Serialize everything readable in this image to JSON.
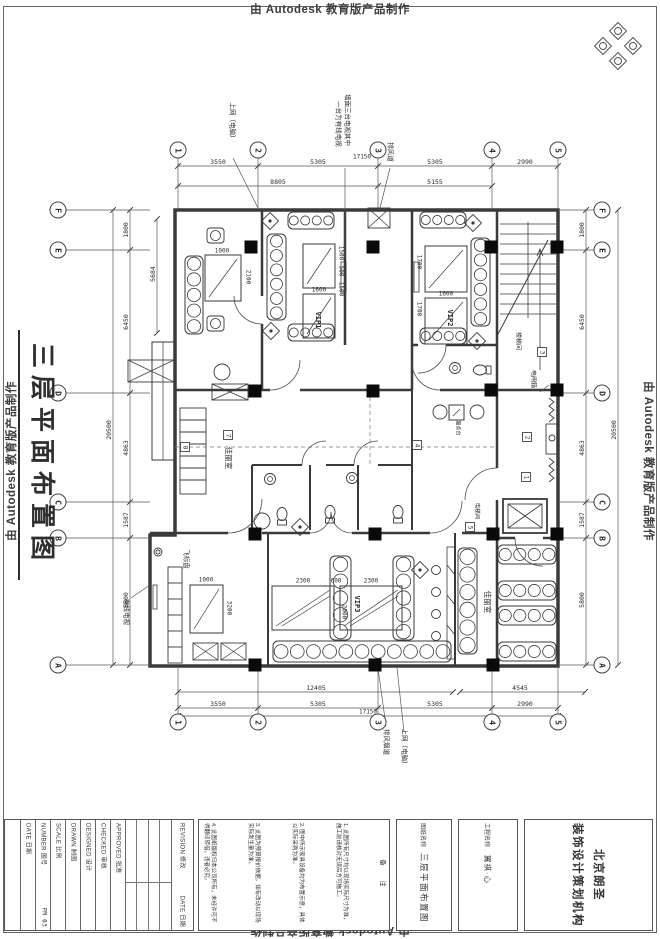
{
  "watermark": {
    "text": "由 Autodesk 教育版产品制作"
  },
  "sheet_title": "三层平面布置图",
  "grid": {
    "top": {
      "y": 150,
      "items": [
        {
          "l": "1",
          "x": 178
        },
        {
          "l": "2",
          "x": 258
        },
        {
          "l": "3",
          "x": 378
        },
        {
          "l": "4",
          "x": 492
        },
        {
          "l": "5",
          "x": 558
        }
      ]
    },
    "bottom": {
      "y": 722,
      "items": [
        {
          "l": "1",
          "x": 178
        },
        {
          "l": "2",
          "x": 258
        },
        {
          "l": "3",
          "x": 378
        },
        {
          "l": "4",
          "x": 492
        },
        {
          "l": "5",
          "x": 558
        }
      ]
    },
    "left": {
      "x": 58,
      "items": [
        {
          "l": "F",
          "y": 210
        },
        {
          "l": "E",
          "y": 250
        },
        {
          "l": "D",
          "y": 393
        },
        {
          "l": "C",
          "y": 502
        },
        {
          "l": "B",
          "y": 538
        },
        {
          "l": "A",
          "y": 665
        }
      ]
    },
    "right": {
      "x": 602,
      "items": [
        {
          "l": "F",
          "y": 210
        },
        {
          "l": "E",
          "y": 250
        },
        {
          "l": "D",
          "y": 393
        },
        {
          "l": "C",
          "y": 502
        },
        {
          "l": "B",
          "y": 538
        },
        {
          "l": "A",
          "y": 665
        }
      ]
    }
  },
  "plan": {
    "markers": [
      {
        "t": "1",
        "x": 526,
        "y": 477
      },
      {
        "t": "2",
        "x": 527,
        "y": 437
      },
      {
        "t": "3",
        "x": 542,
        "y": 352
      },
      {
        "t": "4",
        "x": 417,
        "y": 445
      },
      {
        "t": "5",
        "x": 470,
        "y": 527
      },
      {
        "t": "7",
        "x": 228,
        "y": 435
      },
      {
        "t": "8",
        "x": 185,
        "y": 447
      }
    ],
    "texts": [
      {
        "n": "dim-top",
        "t": "3550",
        "x": 218,
        "y": 162
      },
      {
        "n": "dim-top",
        "t": "5305",
        "x": 318,
        "y": 162
      },
      {
        "n": "dim-top",
        "t": "5305",
        "x": 435,
        "y": 162
      },
      {
        "n": "dim-top",
        "t": "2990",
        "x": 525,
        "y": 162
      },
      {
        "n": "dim-top-total",
        "t": "17150",
        "x": 362,
        "y": 157,
        "s": 6
      },
      {
        "n": "dim-top",
        "t": "8805",
        "x": 278,
        "y": 182
      },
      {
        "n": "dim-top",
        "t": "5155",
        "x": 435,
        "y": 182
      },
      {
        "n": "dim-bottom",
        "t": "12405",
        "x": 316,
        "y": 688
      },
      {
        "n": "dim-bottom",
        "t": "4545",
        "x": 520,
        "y": 688
      },
      {
        "n": "dim-bottom",
        "t": "3550",
        "x": 218,
        "y": 704
      },
      {
        "n": "dim-bottom",
        "t": "5305",
        "x": 318,
        "y": 704
      },
      {
        "n": "dim-bottom",
        "t": "5305",
        "x": 435,
        "y": 704
      },
      {
        "n": "dim-bottom",
        "t": "2990",
        "x": 525,
        "y": 704
      },
      {
        "n": "dim-bottom-total",
        "t": "17150",
        "x": 368,
        "y": 712,
        "s": 6
      },
      {
        "n": "dim-left",
        "t": "1800",
        "x": 126,
        "y": 230,
        "r": -90
      },
      {
        "n": "dim-left",
        "t": "6450",
        "x": 126,
        "y": 322,
        "r": -90
      },
      {
        "n": "dim-left",
        "t": "4863",
        "x": 126,
        "y": 448,
        "r": -90
      },
      {
        "n": "dim-left",
        "t": "1587",
        "x": 126,
        "y": 520,
        "r": -90
      },
      {
        "n": "dim-left",
        "t": "5800",
        "x": 126,
        "y": 600,
        "r": -90
      },
      {
        "n": "dim-left-total",
        "t": "20500",
        "x": 109,
        "y": 430,
        "r": -90
      },
      {
        "n": "dim-inner",
        "t": "5684",
        "x": 153,
        "y": 274,
        "r": -90
      },
      {
        "n": "dim-right",
        "t": "1800",
        "x": 582,
        "y": 230,
        "r": -90
      },
      {
        "n": "dim-right",
        "t": "6450",
        "x": 582,
        "y": 322,
        "r": -90
      },
      {
        "n": "dim-right",
        "t": "4863",
        "x": 582,
        "y": 448,
        "r": -90
      },
      {
        "n": "dim-right",
        "t": "1587",
        "x": 582,
        "y": 520,
        "r": -90
      },
      {
        "n": "dim-right",
        "t": "5800",
        "x": 582,
        "y": 600,
        "r": -90
      },
      {
        "n": "dim-right-total",
        "t": "20500",
        "x": 614,
        "y": 430,
        "r": -90
      },
      {
        "n": "note-internet-top",
        "t": "上网（电脑）",
        "x": 232,
        "y": 122,
        "r": 90,
        "s": 6.5,
        "f": "s"
      },
      {
        "n": "note-tv-wall-1",
        "t": "墙面三台电视其中",
        "x": 347,
        "y": 120,
        "r": 90,
        "s": 6.5,
        "f": "s"
      },
      {
        "n": "note-tv-wall-2",
        "t": "一台为有线电视",
        "x": 338,
        "y": 124,
        "r": 90,
        "s": 6.5,
        "f": "s"
      },
      {
        "n": "note-exhaust-top",
        "t": "排风道",
        "x": 390,
        "y": 152,
        "r": 90,
        "s": 6.5,
        "f": "s"
      },
      {
        "n": "note-exhaust-bottom",
        "t": "排风烟道",
        "x": 386,
        "y": 742,
        "r": 90,
        "s": 6.5,
        "f": "s"
      },
      {
        "n": "note-internet-bottom",
        "t": "上网（电脑）",
        "x": 404,
        "y": 748,
        "r": 90,
        "s": 6.5,
        "f": "s"
      },
      {
        "n": "note-cable-tv",
        "t": "有线电视",
        "x": 126,
        "y": 612,
        "r": 90,
        "s": 6.5,
        "f": "s"
      },
      {
        "n": "room-jiali-mid",
        "t": "佳丽室",
        "x": 228,
        "y": 458,
        "r": 90,
        "s": 7.5,
        "f": "s"
      },
      {
        "n": "room-jiali-br",
        "t": "佳丽室",
        "x": 487,
        "y": 602,
        "r": 90,
        "s": 7.5,
        "f": "s"
      },
      {
        "n": "room-stair",
        "t": "楼梯间",
        "x": 518,
        "y": 341,
        "r": 90,
        "s": 6,
        "f": "s"
      },
      {
        "n": "label-breaker-box",
        "t": "电闸箱",
        "x": 533,
        "y": 379,
        "r": 90,
        "s": 6,
        "f": "s"
      },
      {
        "n": "room-elevator",
        "t": "电梯间",
        "x": 477,
        "y": 511,
        "r": 90,
        "s": 5.5,
        "f": "s"
      },
      {
        "n": "label-service-desk",
        "t": "服务台",
        "x": 458,
        "y": 428,
        "r": 90,
        "s": 5,
        "f": "s"
      },
      {
        "n": "label-dartboard",
        "t": "飞标盘",
        "x": 186,
        "y": 559,
        "r": 90,
        "s": 6.5,
        "f": "s"
      },
      {
        "n": "room-vip1",
        "t": "VIP1",
        "x": 318,
        "y": 320,
        "r": 90,
        "s": 7,
        "b": 1
      },
      {
        "n": "room-vip2",
        "t": "VIP2",
        "x": 450,
        "y": 318,
        "r": 90,
        "s": 7,
        "b": 1
      },
      {
        "n": "room-vip3",
        "t": "VIP3",
        "x": 357,
        "y": 604,
        "r": 90,
        "s": 7,
        "b": 1
      },
      {
        "n": "dim-fur",
        "t": "1000",
        "x": 222,
        "y": 251,
        "s": 6
      },
      {
        "n": "dim-fur",
        "t": "2100",
        "x": 248,
        "y": 277,
        "r": 90,
        "s": 6
      },
      {
        "n": "dim-fur",
        "t": "1600",
        "x": 319,
        "y": 290,
        "s": 6
      },
      {
        "n": "dim-fur",
        "t": "1500",
        "x": 341,
        "y": 253,
        "r": 90,
        "s": 6
      },
      {
        "n": "dim-fur",
        "t": "500",
        "x": 341,
        "y": 271,
        "r": 90,
        "s": 6
      },
      {
        "n": "dim-fur",
        "t": "1500",
        "x": 341,
        "y": 289,
        "r": 90,
        "s": 6
      },
      {
        "n": "dim-fur",
        "t": "1700",
        "x": 419,
        "y": 262,
        "r": 90,
        "s": 6
      },
      {
        "n": "dim-fur",
        "t": "1600",
        "x": 446,
        "y": 294,
        "s": 6
      },
      {
        "n": "dim-fur",
        "t": "1700",
        "x": 419,
        "y": 309,
        "r": 90,
        "s": 6
      },
      {
        "n": "dim-fur",
        "t": "1000",
        "x": 206,
        "y": 580,
        "s": 6
      },
      {
        "n": "dim-fur",
        "t": "3200",
        "x": 229,
        "y": 608,
        "r": 90,
        "s": 6
      },
      {
        "n": "dim-fur",
        "t": "2300",
        "x": 303,
        "y": 581,
        "s": 6
      },
      {
        "n": "dim-fur",
        "t": "600",
        "x": 336,
        "y": 581,
        "s": 6
      },
      {
        "n": "dim-fur",
        "t": "2300",
        "x": 371,
        "y": 581,
        "s": 6
      },
      {
        "n": "dim-fur",
        "t": "2000",
        "x": 344,
        "y": 612,
        "r": 90,
        "s": 6
      }
    ]
  },
  "title_block": {
    "fields": [
      {
        "label": "DATE 日期",
        "value": ""
      },
      {
        "label": "NUMBER 图号",
        "value": "PM 03"
      },
      {
        "label": "SCALE 比例",
        "value": ""
      },
      {
        "label": "DRAWN 制图",
        "value": ""
      },
      {
        "label": "DESIGNED 设计",
        "value": ""
      },
      {
        "label": "CHECKED 审核",
        "value": ""
      },
      {
        "label": "APPROVED 批准",
        "value": ""
      }
    ],
    "revision_label": "REVISION 修改",
    "revision_date": "DATE 日期",
    "notes": {
      "header": "备　注",
      "items": [
        "1. 此图所有尺寸均以现场实际尺寸为准，施工前请核对无误后方可施工。",
        "2. 图中所示家具设备均为布置示意，具体以实际采购为准。",
        "3. 此图为预算报价依据，如有改动以现场实际发生量为准。",
        "4. 此图纸版权归本公司所有，未经许可不得翻印转借，违者必究。"
      ]
    },
    "drawing": {
      "header": "图纸名称",
      "value": "三层平面布置图"
    },
    "project": {
      "header": "工程名称",
      "value": "翼祺·心"
    },
    "company": {
      "line1": "北京朗圣",
      "line2": "装饰设计策划机构"
    }
  }
}
